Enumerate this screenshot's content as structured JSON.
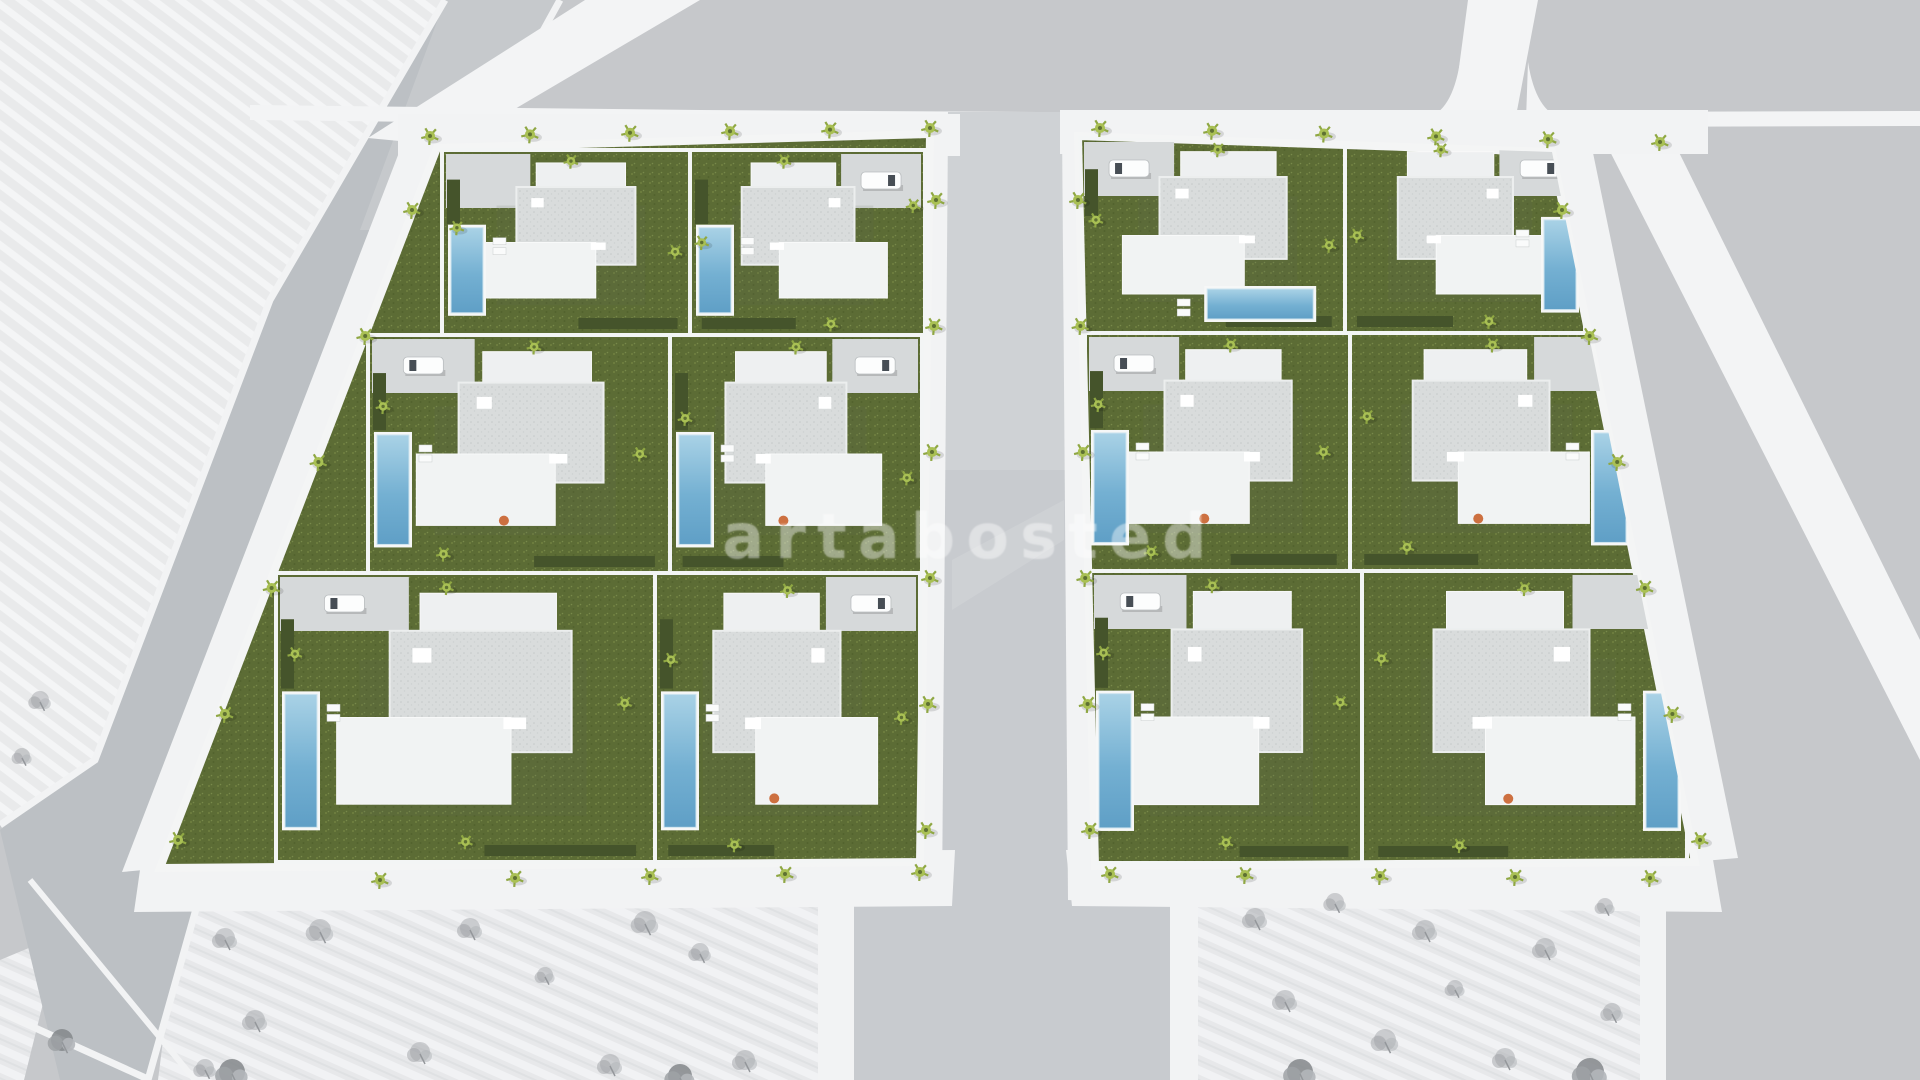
{
  "watermark": {
    "text": "artabosted",
    "color": "rgba(255,255,255,0.30)"
  },
  "palette": {
    "ground": "#c6c8cb",
    "road_asphalt": "#bcc0c4",
    "road_center": "#c8cbcf",
    "road_white": "#f3f4f5",
    "sidewalk": "#f2f3f4",
    "hatch_plot": "#e9eaeb",
    "grass": "#5c6c35",
    "hedge": "#45542b",
    "pool_light": "#a9d2e6",
    "pool_deep": "#5f9fc6",
    "roof_gravel": "#d9dcdc",
    "house_white": "#f1f3f3",
    "palm_green": "#a9c054",
    "sketch_tree": "#a3a6aa",
    "accent_orange": "#cd7040"
  },
  "scene": {
    "shapes": [
      {
        "t": "rect",
        "nm": "ground",
        "x": 0,
        "y": 0,
        "w": 1920,
        "h": 1080,
        "f": "#c6c8cb"
      },
      {
        "t": "poly",
        "nm": "vacant-plot-top-left",
        "p": "0,0 445,0 270,300 95,760 0,822",
        "f": "url(#hatchA)"
      },
      {
        "t": "poly",
        "nm": "vacant-plot-bottom-left",
        "p": "180,906 830,906 830,1080 158,1080",
        "f": "url(#hatchB)"
      },
      {
        "t": "poly",
        "nm": "vacant-plot-bottom-left-sliver",
        "p": "0,960 60,935 24,1080 0,1080",
        "f": "url(#hatchB)"
      },
      {
        "t": "poly",
        "nm": "vacant-plot-bottom-right",
        "p": "1195,906 1640,906 1640,1080 1195,1080",
        "f": "url(#hatchB)"
      },
      {
        "t": "poly",
        "nm": "road-left",
        "p": "445,0 560,0 395,300 235,770 148,1080 60,1080 0,830 95,760 270,300",
        "f": "#bcc0c4"
      },
      {
        "t": "poly",
        "nm": "road-left-light-wash",
        "p": "445,0 560,0 470,230 360,230",
        "f": "#d2d4d7",
        "o": 0.45
      },
      {
        "t": "pline",
        "nm": "curb-left-road-west",
        "p": "445,0 270,300 95,760 0,825",
        "s": "#f2f3f4",
        "sw": 7
      },
      {
        "t": "pline",
        "nm": "curb-left-road-east",
        "p": "560,0 395,300 235,770 148,1080",
        "s": "#f2f3f4",
        "sw": 7
      },
      {
        "t": "line",
        "nm": "curb-bottom-left-crossing",
        "x1": 0,
        "y1": 1012,
        "x2": 150,
        "y2": 1080,
        "s": "#f2f3f4",
        "sw": 7
      },
      {
        "t": "line",
        "nm": "curb-bottom-left-plot",
        "x1": 30,
        "y1": 880,
        "x2": 195,
        "y2": 1080,
        "s": "#f2f3f4",
        "sw": 6
      },
      {
        "t": "poly",
        "nm": "road-top-horizontal",
        "p": "250,105 700,110 1200,113 1920,111 1920,126 1200,128 700,125 250,120",
        "f": "#f3f4f5"
      },
      {
        "t": "poly",
        "nm": "road-top-left-diagonal",
        "p": "368,138 585,0 700,0 452,146",
        "f": "#f3f4f5"
      },
      {
        "t": "poly",
        "nm": "road-top-right-vertical",
        "p": "1468,0 1538,0 1516,116 1452,120",
        "f": "#f3f4f5"
      },
      {
        "t": "path",
        "nm": "curb-flare-left",
        "d": "M1426,118 Q1452,112 1460,62 L1462,120 Z",
        "f": "#f3f4f5"
      },
      {
        "t": "path",
        "nm": "curb-flare-right",
        "d": "M1528,62 Q1536,112 1562,118 L1526,120 Z",
        "f": "#f3f4f5"
      },
      {
        "t": "poly",
        "nm": "road-right-diagonal",
        "p": "1598,128 1664,122 1920,640 1920,760",
        "f": "#f3f4f5"
      },
      {
        "t": "poly",
        "nm": "road-center-and-south",
        "p": "948,112 1062,112 1068,895 1170,895 1170,1080 854,1080 854,895 942,895",
        "f": "#c8cbcf"
      },
      {
        "t": "poly",
        "nm": "road-center-light-wash",
        "p": "948,112 1062,112 1065,470 945,470",
        "f": "#d6d8db",
        "o": 0.55
      },
      {
        "t": "poly",
        "nm": "road-center-streak",
        "p": "952,560 1064,500 1064,540 952,610",
        "f": "#d8dadd",
        "o": 0.4
      },
      {
        "t": "poly",
        "nm": "sidewalk-center-west",
        "p": "906,128 948,126 942,900 896,902",
        "f": "#f2f3f4"
      },
      {
        "t": "poly",
        "nm": "sidewalk-center-east",
        "p": "1062,126 1104,128 1112,902 1068,900",
        "f": "#f2f3f4"
      },
      {
        "t": "rect",
        "nm": "sidewalk-south-road-west",
        "x": 818,
        "y": 895,
        "w": 36,
        "h": 185,
        "f": "#f2f3f4"
      },
      {
        "t": "rect",
        "nm": "sidewalk-south-road-east",
        "x": 1170,
        "y": 895,
        "w": 28,
        "h": 185,
        "f": "#f2f3f4"
      },
      {
        "t": "rect",
        "nm": "sidewalk-top-left-block",
        "x": 398,
        "y": 114,
        "w": 562,
        "h": 42,
        "f": "#f2f3f4"
      },
      {
        "t": "rect",
        "nm": "sidewalk-top-right-block",
        "x": 1060,
        "y": 110,
        "w": 648,
        "h": 44,
        "f": "#f2f3f4"
      },
      {
        "t": "poly",
        "nm": "sidewalk-bottom-left-block",
        "p": "142,856 955,850 952,906 134,912",
        "f": "#f2f3f4"
      },
      {
        "t": "poly",
        "nm": "sidewalk-bottom-right-block",
        "p": "1066,850 1712,854 1722,912 1072,906",
        "f": "#f2f3f4"
      },
      {
        "t": "poly",
        "nm": "sidewalk-left-block-west",
        "p": "400,150 444,148 166,868 122,872",
        "f": "#f2f3f4"
      },
      {
        "t": "poly",
        "nm": "sidewalk-right-block-east",
        "p": "1548,150 1592,148 1738,858 1692,862",
        "f": "#f2f3f4"
      },
      {
        "t": "rect",
        "nm": "sidewalk-right-plot-east",
        "x": 1640,
        "y": 906,
        "w": 26,
        "h": 174,
        "f": "#f2f3f4"
      }
    ],
    "sketch_trees": [
      {
        "x": 40,
        "y": 700,
        "s": 0.9
      },
      {
        "x": 22,
        "y": 756,
        "s": 0.8
      },
      {
        "x": 225,
        "y": 938,
        "s": 1.0
      },
      {
        "x": 320,
        "y": 930,
        "s": 1.1
      },
      {
        "x": 470,
        "y": 928,
        "s": 1.0
      },
      {
        "x": 645,
        "y": 922,
        "s": 1.1
      },
      {
        "x": 700,
        "y": 952,
        "s": 0.9
      },
      {
        "x": 545,
        "y": 975,
        "s": 0.8
      },
      {
        "x": 255,
        "y": 1020,
        "s": 1.0
      },
      {
        "x": 420,
        "y": 1052,
        "s": 1.0
      },
      {
        "x": 610,
        "y": 1064,
        "s": 1.0
      },
      {
        "x": 205,
        "y": 1068,
        "s": 0.9
      },
      {
        "x": 745,
        "y": 1060,
        "s": 1.0
      },
      {
        "x": 232,
        "y": 1072,
        "s": 1.3,
        "d": true
      },
      {
        "x": 680,
        "y": 1076,
        "s": 1.2,
        "d": true
      },
      {
        "x": 62,
        "y": 1040,
        "s": 1.1,
        "d": true
      },
      {
        "x": 1255,
        "y": 918,
        "s": 1.0
      },
      {
        "x": 1335,
        "y": 902,
        "s": 0.9
      },
      {
        "x": 1425,
        "y": 930,
        "s": 1.0
      },
      {
        "x": 1545,
        "y": 948,
        "s": 1.0
      },
      {
        "x": 1605,
        "y": 906,
        "s": 0.8
      },
      {
        "x": 1285,
        "y": 1000,
        "s": 1.0
      },
      {
        "x": 1385,
        "y": 1040,
        "s": 1.1
      },
      {
        "x": 1505,
        "y": 1058,
        "s": 1.0
      },
      {
        "x": 1612,
        "y": 1012,
        "s": 0.9
      },
      {
        "x": 1455,
        "y": 988,
        "s": 0.8
      },
      {
        "x": 1300,
        "y": 1072,
        "s": 1.3,
        "d": true
      },
      {
        "x": 1590,
        "y": 1072,
        "s": 1.4,
        "d": true
      }
    ],
    "street_palm_rows": [
      {
        "x1": 430,
        "y1": 136,
        "x2": 930,
        "y2": 128,
        "n": 6
      },
      {
        "x1": 1100,
        "y1": 128,
        "x2": 1660,
        "y2": 142,
        "n": 6
      },
      {
        "x1": 936,
        "y1": 200,
        "x2": 926,
        "y2": 830,
        "n": 6
      },
      {
        "x1": 1078,
        "y1": 200,
        "x2": 1090,
        "y2": 830,
        "n": 6
      },
      {
        "x1": 412,
        "y1": 210,
        "x2": 178,
        "y2": 840,
        "n": 6
      },
      {
        "x1": 1562,
        "y1": 210,
        "x2": 1700,
        "y2": 840,
        "n": 6
      },
      {
        "x1": 380,
        "y1": 880,
        "x2": 920,
        "y2": 872,
        "n": 5
      },
      {
        "x1": 1110,
        "y1": 874,
        "x2": 1650,
        "y2": 878,
        "n": 5
      }
    ]
  },
  "blocks": [
    {
      "name": "villa-block-west",
      "outline": "437,148 930,134 920,862 160,868",
      "villas": [
        {
          "x": 442,
          "y": 150,
          "w": 248,
          "h": 185,
          "drive": "tl",
          "pool": "left",
          "car": false,
          "accent": false,
          "palms": [
            [
              0.06,
              0.42
            ],
            [
              0.52,
              0.06
            ],
            [
              0.94,
              0.55
            ]
          ]
        },
        {
          "x": 690,
          "y": 150,
          "w": 235,
          "h": 185,
          "drive": "tr",
          "pool": "left",
          "car": true,
          "accent": false,
          "palms": [
            [
              0.05,
              0.5
            ],
            [
              0.4,
              0.06
            ],
            [
              0.95,
              0.3
            ],
            [
              0.6,
              0.94
            ]
          ]
        },
        {
          "x": 368,
          "y": 335,
          "w": 302,
          "h": 238,
          "drive": "tl",
          "pool": "left",
          "car": true,
          "accent": true,
          "palms": [
            [
              0.05,
              0.3
            ],
            [
              0.55,
              0.05
            ],
            [
              0.9,
              0.5
            ],
            [
              0.25,
              0.92
            ]
          ]
        },
        {
          "x": 670,
          "y": 335,
          "w": 252,
          "h": 238,
          "drive": "tr",
          "pool": "left",
          "car": true,
          "accent": true,
          "palms": [
            [
              0.06,
              0.35
            ],
            [
              0.5,
              0.05
            ],
            [
              0.94,
              0.6
            ]
          ]
        },
        {
          "x": 276,
          "y": 573,
          "w": 379,
          "h": 289,
          "drive": "tl",
          "pool": "left",
          "car": true,
          "accent": false,
          "palms": [
            [
              0.05,
              0.28
            ],
            [
              0.45,
              0.05
            ],
            [
              0.92,
              0.45
            ],
            [
              0.5,
              0.93
            ]
          ]
        },
        {
          "x": 655,
          "y": 573,
          "w": 265,
          "h": 289,
          "drive": "tr",
          "pool": "left",
          "car": true,
          "accent": true,
          "palms": [
            [
              0.06,
              0.3
            ],
            [
              0.5,
              0.06
            ],
            [
              0.93,
              0.5
            ],
            [
              0.3,
              0.94
            ]
          ]
        }
      ]
    },
    {
      "name": "villa-block-east",
      "outline": "1078,136 1552,152 1695,862 1095,866",
      "villas": [
        {
          "x": 1080,
          "y": 138,
          "w": 265,
          "h": 195,
          "drive": "tl",
          "pool": "bottom",
          "car": true,
          "accent": false,
          "palms": [
            [
              0.06,
              0.42
            ],
            [
              0.52,
              0.06
            ],
            [
              0.94,
              0.55
            ]
          ]
        },
        {
          "x": 1345,
          "y": 138,
          "w": 240,
          "h": 195,
          "drive": "tr",
          "pool": "right",
          "car": true,
          "accent": false,
          "palms": [
            [
              0.05,
              0.5
            ],
            [
              0.4,
              0.06
            ],
            [
              0.6,
              0.94
            ]
          ]
        },
        {
          "x": 1085,
          "y": 333,
          "w": 265,
          "h": 238,
          "drive": "tl",
          "pool": "left",
          "car": true,
          "accent": true,
          "palms": [
            [
              0.05,
              0.3
            ],
            [
              0.55,
              0.05
            ],
            [
              0.9,
              0.5
            ],
            [
              0.25,
              0.92
            ]
          ]
        },
        {
          "x": 1350,
          "y": 333,
          "w": 285,
          "h": 238,
          "drive": "tr",
          "pool": "right",
          "car": false,
          "accent": true,
          "palms": [
            [
              0.06,
              0.35
            ],
            [
              0.5,
              0.05
            ],
            [
              0.2,
              0.9
            ]
          ]
        },
        {
          "x": 1090,
          "y": 571,
          "w": 272,
          "h": 292,
          "drive": "tl",
          "pool": "left",
          "car": true,
          "accent": false,
          "palms": [
            [
              0.05,
              0.28
            ],
            [
              0.45,
              0.05
            ],
            [
              0.92,
              0.45
            ],
            [
              0.5,
              0.93
            ]
          ]
        },
        {
          "x": 1362,
          "y": 571,
          "w": 325,
          "h": 292,
          "drive": "tr",
          "pool": "right",
          "car": false,
          "accent": true,
          "palms": [
            [
              0.06,
              0.3
            ],
            [
              0.5,
              0.06
            ],
            [
              0.3,
              0.94
            ]
          ]
        }
      ]
    }
  ]
}
